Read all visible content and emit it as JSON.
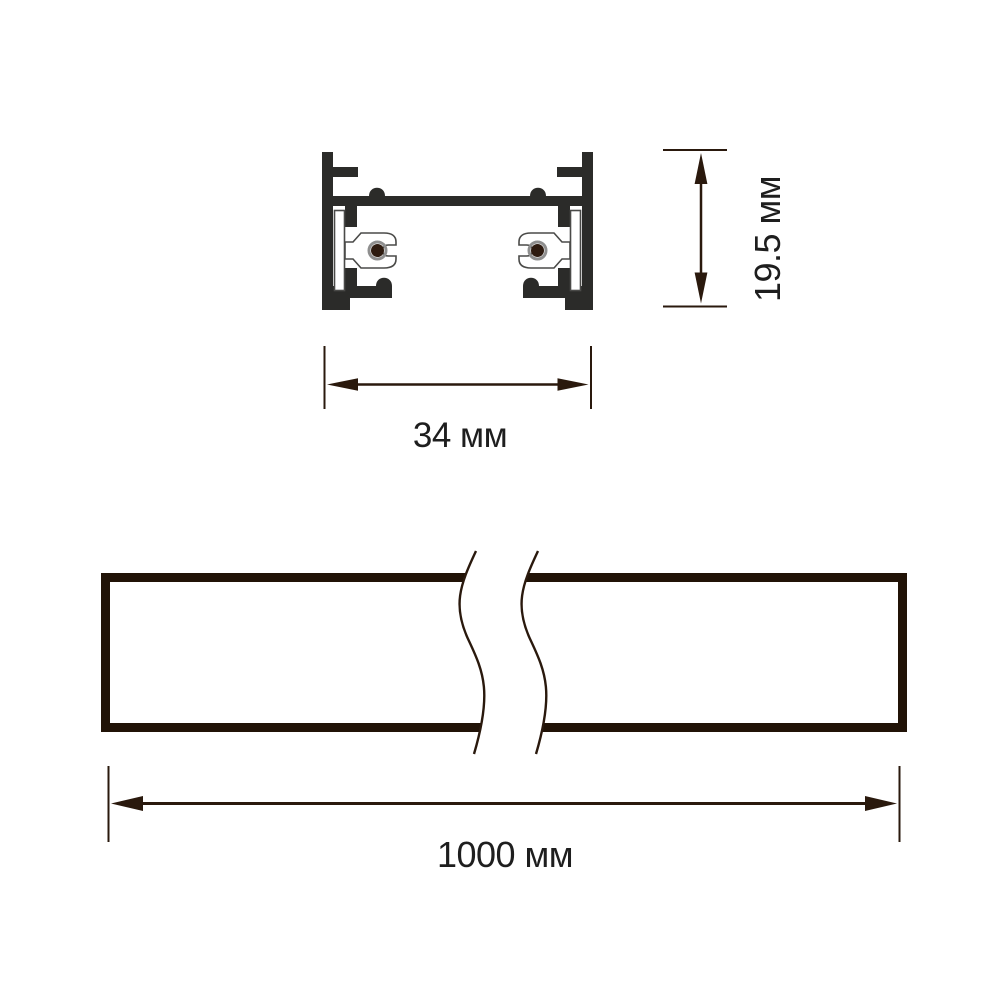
{
  "drawing": {
    "type": "technical-dimension-drawing",
    "subject": "track-profile",
    "views": {
      "cross_section": {
        "width_label": "34 мм",
        "height_label": "19.5 мм"
      },
      "side_view": {
        "length_label": "1000 мм"
      }
    },
    "colors": {
      "profile_fill": "#2b2b29",
      "insulator_fill": "#ffffff",
      "insulator_outline": "#4a4a48",
      "conductor_fill": "#2e1b10",
      "conductor_ring": "#8f8f8f",
      "rail_outline": "#211307",
      "dimension_line": "#2a190d",
      "label_text": "#1e1e1e",
      "background": "#ffffff"
    }
  }
}
